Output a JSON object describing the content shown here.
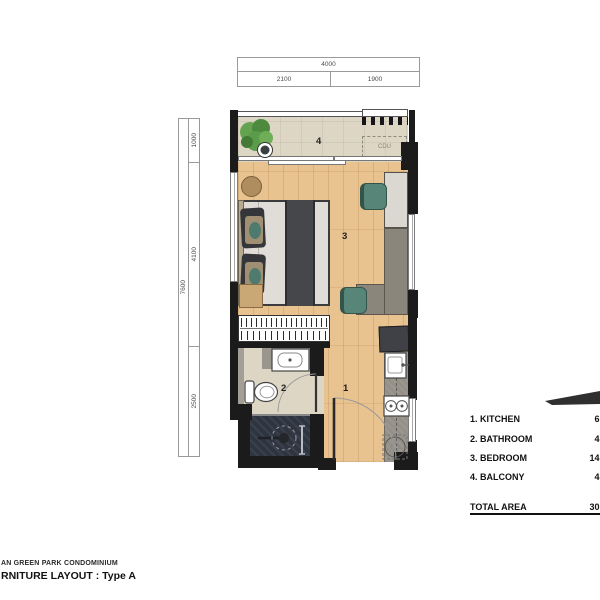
{
  "dimensions": {
    "top": {
      "total": "4000",
      "segments": [
        "2100",
        "1900"
      ]
    },
    "left": {
      "total": "7600",
      "segments": [
        "1000",
        "4100",
        "2500"
      ]
    }
  },
  "plan": {
    "room_labels": {
      "kitchen": "1",
      "bathroom": "2",
      "bedroom": "3",
      "balcony": "4"
    },
    "cdu_label": "CDU"
  },
  "legend": {
    "items": [
      {
        "name": "1. KITCHEN",
        "area": "6.5"
      },
      {
        "name": "2. BATHROOM",
        "area": "4.6"
      },
      {
        "name": "3. BEDROOM",
        "area": "14.5"
      },
      {
        "name": "4. BALCONY",
        "area": "4.7"
      }
    ],
    "total_label": "TOTAL AREA",
    "total_value": "30.3"
  },
  "titles": {
    "project": "AN GREEN PARK CONDOMINIUM",
    "layout": "RNITURE LAYOUT : Type A"
  },
  "colors": {
    "wood": "#e8c28f",
    "tile": "#ded6c4",
    "wall": "#1b1b1c",
    "teal": "#578578",
    "plant": "#5a9c49",
    "shower": "#2f3540",
    "counter": "#9b968d",
    "desk": "#8b867c",
    "cabinet": "#dbd8d2"
  }
}
